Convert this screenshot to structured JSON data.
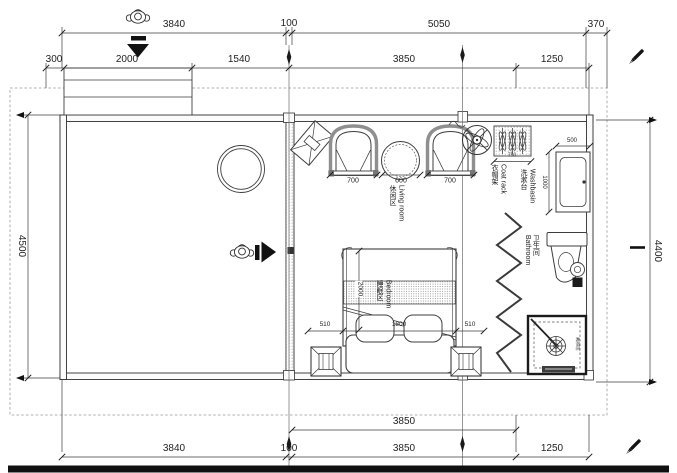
{
  "colors": {
    "line": "#3d3d3d",
    "accent": "#111111",
    "dash": "#999999",
    "wall_fill": "#fbfbfb"
  },
  "dims": {
    "top1": {
      "a": "3840",
      "b": "100",
      "c": "5050",
      "d": "370"
    },
    "top2": {
      "a": "300",
      "b": "2000",
      "c": "1540",
      "d": "3850",
      "e": "1250"
    },
    "left": "4500",
    "right": "4400",
    "bottom1": "3850",
    "bottom2": {
      "a": "3840",
      "b": "100",
      "c": "3850",
      "d": "1250"
    },
    "living": {
      "a": "700",
      "b": "600",
      "c": "700"
    },
    "bed": {
      "length": "2000",
      "a": "510",
      "b": "1800",
      "c": "510"
    },
    "basin": {
      "w": "500",
      "h": "1000"
    },
    "rack": "750"
  },
  "labels": {
    "living": {
      "zh": "休闲区",
      "en": "Living room"
    },
    "bedroom": {
      "zh": "睡眠区",
      "en": "Bedroom"
    },
    "bathroom": {
      "zh": "卫生间",
      "en": "Bathroom"
    },
    "washbasin": {
      "zh": "洗漱台",
      "en": "Washbasin"
    },
    "coat_rack": {
      "zh": "衣帽架",
      "en": "Coat rack"
    },
    "shower": {
      "zh": "淋浴间",
      "en": ""
    }
  }
}
